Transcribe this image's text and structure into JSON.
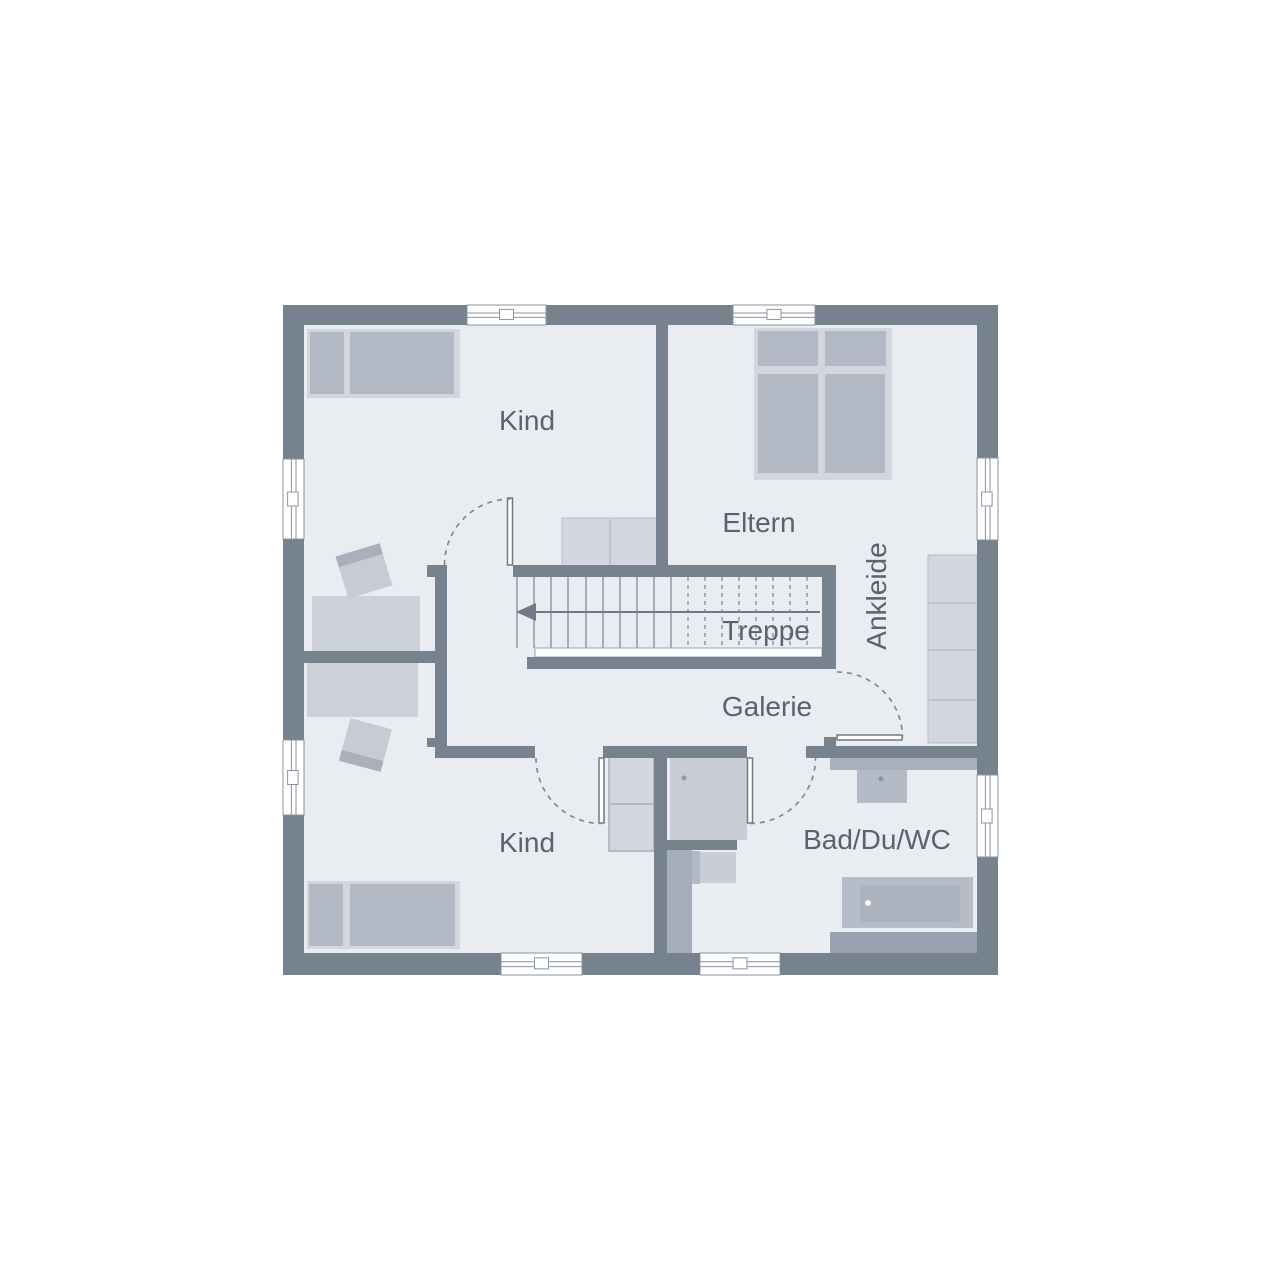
{
  "page": {
    "background": "#ffffff",
    "width": 1280,
    "height": 1280
  },
  "rooms": [
    {
      "id": "kind-top",
      "label": "Kind"
    },
    {
      "id": "eltern",
      "label": "Eltern"
    },
    {
      "id": "ankleide",
      "label": "Ankleide"
    },
    {
      "id": "treppe",
      "label": "Treppe"
    },
    {
      "id": "galerie",
      "label": "Galerie"
    },
    {
      "id": "kind-bottom",
      "label": "Kind"
    },
    {
      "id": "bad",
      "label": "Bad/Du/WC"
    }
  ],
  "plan": {
    "colors": {
      "wall": "#77828F",
      "floor": "#E9ECF1",
      "furn_light": "#D2D6DE",
      "furn_mid": "#B2B8C4",
      "desk": "#CBD0D9",
      "chair": "#C6CBD5",
      "chair_band": "#A9B0BC",
      "counter": "#A9B0BC",
      "shower": "#C9CDD6",
      "tub_surround": "#B7BDC8",
      "tub_inner": "#ACB3BF",
      "band_dark": "#99A1AF",
      "install": "#A6ADBA",
      "text": "#5A6270",
      "tread": "#8A93A2",
      "arc": "#7B8596",
      "window_stroke": "#8B94A2",
      "arrow": "#6F7987",
      "white": "#FFFFFF",
      "divider": "#B7BDC8"
    },
    "elements": [
      {
        "t": "rect",
        "name": "floor",
        "x": 304,
        "y": 325,
        "w": 673,
        "h": 628,
        "fill": "#E9ECF1"
      },
      {
        "t": "rect",
        "name": "bed-kind-top-frame",
        "x": 307,
        "y": 329,
        "w": 153,
        "h": 69,
        "fill": "#D2D6DE"
      },
      {
        "t": "rect",
        "name": "bed-kind-top-pillow",
        "x": 310,
        "y": 332,
        "w": 34,
        "h": 62,
        "fill": "#B2B8C4"
      },
      {
        "t": "rect",
        "name": "bed-kind-top-mattress",
        "x": 350,
        "y": 332,
        "w": 104,
        "h": 62,
        "fill": "#B2B8C4"
      },
      {
        "t": "rect",
        "name": "wardrobe-kind-top",
        "x": 562,
        "y": 518,
        "w": 95,
        "h": 48,
        "fill": "#D2D6DE",
        "stroke": "#B7BDC8",
        "sw": 1
      },
      {
        "t": "line",
        "name": "wardrobe-kind-top-divider",
        "x1": 610,
        "y1": 519,
        "x2": 610,
        "y2": 565,
        "stroke": "#B7BDC8",
        "sw": 1.5
      },
      {
        "t": "rect",
        "name": "desk-kind-top",
        "x": 312,
        "y": 596,
        "w": 108,
        "h": 55,
        "fill": "#CBD0D9"
      },
      {
        "t": "rect",
        "name": "chair-kind-top",
        "x": 341,
        "y": 549,
        "w": 46,
        "h": 44,
        "fill": "#C6CBD5",
        "rot": -17
      },
      {
        "t": "rect",
        "name": "chair-kind-top-backrest",
        "x": 341,
        "y": 549,
        "w": 46,
        "h": 11,
        "fill": "#A9B0BC",
        "rot": -17,
        "ox": 364,
        "oy": 571
      },
      {
        "t": "rect",
        "name": "desk-kind-bottom",
        "x": 307,
        "y": 663,
        "w": 111,
        "h": 54,
        "fill": "#CBD0D9"
      },
      {
        "t": "rect",
        "name": "chair-kind-bottom",
        "x": 344,
        "y": 723,
        "w": 43,
        "h": 44,
        "fill": "#C6CBD5",
        "rot": 15
      },
      {
        "t": "rect",
        "name": "chair-kind-bottom-backrest",
        "x": 344,
        "y": 756,
        "w": 43,
        "h": 11,
        "fill": "#A9B0BC",
        "rot": 15,
        "ox": 365.5,
        "oy": 745
      },
      {
        "t": "rect",
        "name": "bed-kind-bottom-frame",
        "x": 307,
        "y": 881,
        "w": 153,
        "h": 68,
        "fill": "#D2D6DE"
      },
      {
        "t": "rect",
        "name": "bed-kind-bottom-pillow",
        "x": 309,
        "y": 884,
        "w": 34,
        "h": 62,
        "fill": "#B2B8C4"
      },
      {
        "t": "rect",
        "name": "bed-kind-bottom-mattress",
        "x": 350,
        "y": 884,
        "w": 105,
        "h": 62,
        "fill": "#B2B8C4"
      },
      {
        "t": "rect",
        "name": "wardrobe-kind-bottom",
        "x": 609,
        "y": 757,
        "w": 45,
        "h": 94,
        "fill": "#D2D6DE",
        "stroke": "#A7AEBB",
        "sw": 1.5
      },
      {
        "t": "line",
        "name": "wardrobe-kind-bottom-divider",
        "x1": 610,
        "y1": 804,
        "x2": 653,
        "y2": 804,
        "stroke": "#A7AEBB",
        "sw": 1.5
      },
      {
        "t": "rect",
        "name": "bed-eltern-frame",
        "x": 754,
        "y": 328,
        "w": 138,
        "h": 152,
        "fill": "#D2D6DE"
      },
      {
        "t": "rect",
        "name": "bed-eltern-pillow-left",
        "x": 758,
        "y": 331,
        "w": 60,
        "h": 35,
        "fill": "#B2B8C4"
      },
      {
        "t": "rect",
        "name": "bed-eltern-pillow-right",
        "x": 825,
        "y": 331,
        "w": 61,
        "h": 35,
        "fill": "#B2B8C4"
      },
      {
        "t": "rect",
        "name": "bed-eltern-mattress-left",
        "x": 758,
        "y": 374,
        "w": 60,
        "h": 99,
        "fill": "#B2B8C4"
      },
      {
        "t": "rect",
        "name": "bed-eltern-mattress-right",
        "x": 825,
        "y": 374,
        "w": 60,
        "h": 99,
        "fill": "#B2B8C4"
      },
      {
        "t": "rect",
        "name": "wardrobe-ankleide",
        "x": 928,
        "y": 555,
        "w": 49,
        "h": 188,
        "fill": "#D2D6DE",
        "stroke": "#B7BDC8",
        "sw": 1
      },
      {
        "t": "line",
        "name": "wardrobe-ankleide-divider-1",
        "x1": 929,
        "y1": 603,
        "x2": 976,
        "y2": 603,
        "stroke": "#B7BDC8",
        "sw": 1.5
      },
      {
        "t": "line",
        "name": "wardrobe-ankleide-divider-2",
        "x1": 929,
        "y1": 650,
        "x2": 976,
        "y2": 650,
        "stroke": "#B7BDC8",
        "sw": 1.5
      },
      {
        "t": "line",
        "name": "wardrobe-ankleide-divider-3",
        "x1": 929,
        "y1": 700,
        "x2": 976,
        "y2": 700,
        "stroke": "#B7BDC8",
        "sw": 1.5
      },
      {
        "t": "rect",
        "name": "vanity-counter",
        "x": 830,
        "y": 758,
        "w": 147,
        "h": 12,
        "fill": "#A9B0BC"
      },
      {
        "t": "rect",
        "name": "washbasin",
        "x": 857,
        "y": 770,
        "w": 50,
        "h": 33,
        "fill": "#B4BAC6"
      },
      {
        "t": "circle",
        "name": "washbasin-drain",
        "cx": 881,
        "cy": 779,
        "r": 2.5,
        "fill": "#8A93A2"
      },
      {
        "t": "rect",
        "name": "shower",
        "x": 670,
        "y": 757,
        "w": 77,
        "h": 83,
        "fill": "#C9CDD6"
      },
      {
        "t": "circle",
        "name": "shower-drain",
        "cx": 684,
        "cy": 778,
        "r": 2.5,
        "fill": "#949CAA"
      },
      {
        "t": "rect",
        "name": "toilet-tank",
        "x": 683,
        "y": 851,
        "w": 17,
        "h": 33,
        "fill": "#B2B8C4"
      },
      {
        "t": "rect",
        "name": "toilet-bowl",
        "x": 700,
        "y": 852,
        "w": 36,
        "h": 31,
        "fill": "#C9CDD6"
      },
      {
        "t": "rect",
        "name": "bathtub-surround",
        "x": 842,
        "y": 877,
        "w": 131,
        "h": 51,
        "fill": "#B7BDC8"
      },
      {
        "t": "rect",
        "name": "bathtub",
        "x": 860,
        "y": 885,
        "w": 100,
        "h": 37,
        "rx": 4,
        "fill": "#ACB3BF"
      },
      {
        "t": "circle",
        "name": "bathtub-drain",
        "cx": 868,
        "cy": 903,
        "r": 3,
        "fill": "#F4F5F8"
      },
      {
        "t": "rect",
        "name": "bath-bottom-band",
        "x": 830,
        "y": 932,
        "w": 147,
        "h": 21,
        "fill": "#99A1AF"
      },
      {
        "t": "rect",
        "name": "installation-strip",
        "x": 667,
        "y": 848,
        "w": 25,
        "h": 105,
        "fill": "#A6ADBA"
      },
      {
        "t": "stairs",
        "name": "stair-treads",
        "y1": 577,
        "y2": 648,
        "solid": [
          517,
          534,
          551,
          568,
          586,
          603,
          620,
          637,
          654,
          671
        ],
        "dashed": [
          688,
          705,
          722,
          739,
          756,
          773,
          790,
          807
        ],
        "stroke": "#8A93A2"
      },
      {
        "t": "rect",
        "name": "stair-railing",
        "x": 535,
        "y": 648,
        "w": 287,
        "h": 9,
        "fill": "#FFFFFF",
        "stroke": "#9AA2B0",
        "sw": 1
      },
      {
        "t": "line",
        "name": "stair-direction-line",
        "x1": 534,
        "y1": 612,
        "x2": 820,
        "y2": 612,
        "stroke": "#6F7987",
        "sw": 2
      },
      {
        "t": "poly",
        "name": "stair-direction-arrowhead",
        "pts": "516,612 536,603 536,621",
        "fill": "#6F7987"
      },
      {
        "t": "rect",
        "name": "wall-divider-top-rooms",
        "x": 656,
        "y": 325,
        "w": 12,
        "h": 252,
        "fill": "#77828F"
      },
      {
        "t": "rect",
        "name": "wall-stair-north",
        "x": 513,
        "y": 565,
        "w": 323,
        "h": 12,
        "fill": "#77828F"
      },
      {
        "t": "rect",
        "name": "wall-stair-east",
        "x": 822,
        "y": 565,
        "w": 14,
        "h": 104,
        "fill": "#77828F"
      },
      {
        "t": "rect",
        "name": "wall-stair-south",
        "x": 527,
        "y": 657,
        "w": 309,
        "h": 12,
        "fill": "#77828F"
      },
      {
        "t": "rect",
        "name": "wall-hall-stub",
        "x": 427,
        "y": 565,
        "w": 20,
        "h": 12,
        "fill": "#77828F"
      },
      {
        "t": "rect",
        "name": "wall-hall-vertical",
        "x": 435,
        "y": 577,
        "w": 12,
        "h": 181,
        "fill": "#77828F"
      },
      {
        "t": "rect",
        "name": "wall-left-rooms-divider",
        "x": 304,
        "y": 651,
        "w": 131,
        "h": 12,
        "fill": "#77828F"
      },
      {
        "t": "rect",
        "name": "wall-hall-south-west",
        "x": 435,
        "y": 746,
        "w": 100,
        "h": 12,
        "fill": "#77828F"
      },
      {
        "t": "rect",
        "name": "wall-hall-south-east",
        "x": 603,
        "y": 746,
        "w": 144,
        "h": 12,
        "fill": "#77828F"
      },
      {
        "t": "rect",
        "name": "wall-kind-bad-divider",
        "x": 654,
        "y": 746,
        "w": 13,
        "h": 207,
        "fill": "#77828F"
      },
      {
        "t": "rect",
        "name": "wall-shower-south",
        "x": 667,
        "y": 840,
        "w": 70,
        "h": 10,
        "fill": "#77828F"
      },
      {
        "t": "rect",
        "name": "wall-bad-north",
        "x": 806,
        "y": 746,
        "w": 171,
        "h": 12,
        "fill": "#77828F"
      },
      {
        "t": "rect",
        "name": "wall-bad-door-step",
        "x": 824,
        "y": 737,
        "w": 12,
        "h": 9,
        "fill": "#77828F"
      },
      {
        "t": "rect",
        "name": "wall-hall-notch",
        "x": 427,
        "y": 738,
        "w": 8,
        "h": 9,
        "fill": "#77828F"
      },
      {
        "t": "rect",
        "name": "outer-wall-top",
        "x": 283,
        "y": 305,
        "w": 715,
        "h": 20,
        "fill": "#77828F"
      },
      {
        "t": "rect",
        "name": "outer-wall-bottom",
        "x": 283,
        "y": 953,
        "w": 715,
        "h": 22,
        "fill": "#77828F"
      },
      {
        "t": "rect",
        "name": "outer-wall-left",
        "x": 283,
        "y": 305,
        "w": 21,
        "h": 670,
        "fill": "#77828F"
      },
      {
        "t": "rect",
        "name": "outer-wall-right",
        "x": 977,
        "y": 305,
        "w": 21,
        "h": 670,
        "fill": "#77828F"
      },
      {
        "t": "window",
        "name": "window-top-left",
        "x": 467,
        "y": 305,
        "w": 79,
        "h": 20,
        "dir": "h"
      },
      {
        "t": "window",
        "name": "window-top-right",
        "x": 733,
        "y": 305,
        "w": 82,
        "h": 20,
        "dir": "h"
      },
      {
        "t": "window",
        "name": "window-bottom-left",
        "x": 501,
        "y": 953,
        "w": 81,
        "h": 22,
        "dir": "h"
      },
      {
        "t": "window",
        "name": "window-bottom-right",
        "x": 700,
        "y": 953,
        "w": 80,
        "h": 22,
        "dir": "h"
      },
      {
        "t": "window",
        "name": "window-left-upper",
        "x": 283,
        "y": 459,
        "w": 21,
        "h": 80,
        "dir": "v"
      },
      {
        "t": "window",
        "name": "window-left-lower",
        "x": 283,
        "y": 740,
        "w": 21,
        "h": 75,
        "dir": "v"
      },
      {
        "t": "window",
        "name": "window-right-upper",
        "x": 977,
        "y": 458,
        "w": 21,
        "h": 82,
        "dir": "v"
      },
      {
        "t": "window",
        "name": "window-right-lower",
        "x": 977,
        "y": 775,
        "w": 21,
        "h": 82,
        "dir": "v"
      },
      {
        "t": "rect",
        "name": "door-leaf-kind-top",
        "x": 507.5,
        "y": 498,
        "w": 5,
        "h": 67,
        "fill": "#FFFFFF",
        "stroke": "#6F7987",
        "sw": 1.5
      },
      {
        "t": "path",
        "name": "door-swing-kind-top",
        "d": "M444.5 565 A66 66 0 0 1 510.5 499",
        "stroke": "#7B8596",
        "dash": "5 5"
      },
      {
        "t": "rect",
        "name": "door-leaf-kind-bottom",
        "x": 599,
        "y": 758,
        "w": 5,
        "h": 65,
        "fill": "#FFFFFF",
        "stroke": "#6F7987",
        "sw": 1.5
      },
      {
        "t": "path",
        "name": "door-swing-kind-bottom",
        "d": "M536 758 A65.5 65.5 0 0 0 601.5 823.5",
        "stroke": "#7B8596",
        "dash": "5 5"
      },
      {
        "t": "rect",
        "name": "door-leaf-bad",
        "x": 747.5,
        "y": 758,
        "w": 5,
        "h": 65,
        "fill": "#FFFFFF",
        "stroke": "#6F7987",
        "sw": 1.5
      },
      {
        "t": "path",
        "name": "door-swing-bad",
        "d": "M750 823.5 A65.5 65.5 0 0 0 815.5 758",
        "stroke": "#7B8596",
        "dash": "5 5"
      },
      {
        "t": "rect",
        "name": "door-leaf-ankleide",
        "x": 837,
        "y": 735,
        "w": 65,
        "h": 5,
        "fill": "#FFFFFF",
        "stroke": "#6F7987",
        "sw": 1.5
      },
      {
        "t": "path",
        "name": "door-swing-ankleide",
        "d": "M837 672 A65.5 65.5 0 0 1 902.5 737.5",
        "stroke": "#7B8596",
        "dash": "5 5"
      },
      {
        "t": "text",
        "name": "room-label-kind-top",
        "text": "Kind",
        "x": 527,
        "y": 430,
        "size": 28
      },
      {
        "t": "text",
        "name": "room-label-eltern",
        "text": "Eltern",
        "x": 759,
        "y": 532,
        "size": 28
      },
      {
        "t": "text",
        "name": "room-label-ankleide",
        "text": "Ankleide",
        "x": 886,
        "y": 596,
        "size": 28,
        "rot": -90
      },
      {
        "t": "text",
        "name": "room-label-treppe",
        "text": "Treppe",
        "x": 766,
        "y": 640,
        "size": 28
      },
      {
        "t": "text",
        "name": "room-label-galerie",
        "text": "Galerie",
        "x": 767,
        "y": 716,
        "size": 28
      },
      {
        "t": "text",
        "name": "room-label-kind-bottom",
        "text": "Kind",
        "x": 527,
        "y": 852,
        "size": 28
      },
      {
        "t": "text",
        "name": "room-label-bad",
        "text": "Bad/Du/WC",
        "x": 877,
        "y": 849,
        "size": 28
      }
    ]
  }
}
